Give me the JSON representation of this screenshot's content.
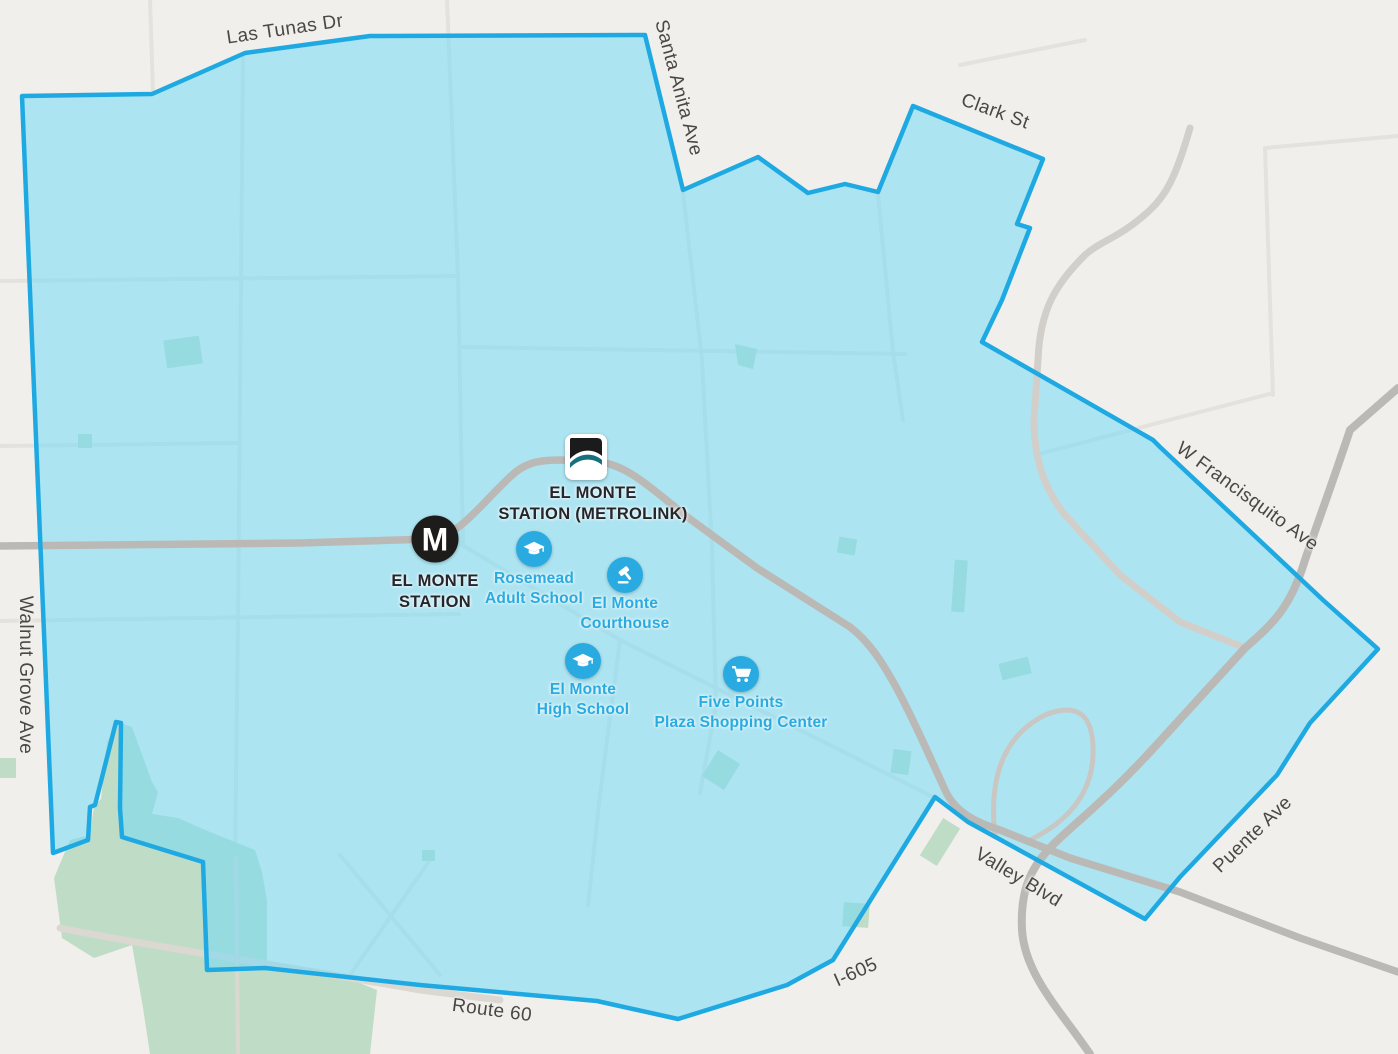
{
  "streets": [
    {
      "label": "Las Tunas Dr"
    },
    {
      "label": "Santa Anita Ave"
    },
    {
      "label": "Clark St"
    },
    {
      "label": "W Francisquito Ave"
    },
    {
      "label": "Walnut Grove Ave"
    },
    {
      "label": "Valley Blvd"
    },
    {
      "label": "Puente Ave"
    },
    {
      "label": "I-605"
    },
    {
      "label": "Route 60"
    }
  ],
  "stations": [
    {
      "line1": "EL MONTE",
      "line2": "STATION (METROLINK)"
    },
    {
      "line1": "EL MONTE",
      "line2": "STATION",
      "logo_letter": "M"
    }
  ],
  "pois": [
    {
      "line1": "Rosemead",
      "line2": "Adult School"
    },
    {
      "line1": "El Monte",
      "line2": "Courthouse"
    },
    {
      "line1": "El Monte",
      "line2": "High School"
    },
    {
      "line1": "Five Points",
      "line2": "Plaza Shopping Center"
    }
  ],
  "colors": {
    "background": "#f1efeb",
    "service_area_fill": "#ace4f2",
    "service_area_border": "#1fa9e2",
    "poi_blue": "#29abe2",
    "park_green": "#bfdcc6",
    "road_gray": "#bbb9b6",
    "street_label_gray": "#4a4745",
    "station_label_dark": "#26252a",
    "metrolink_teal": "#15717d"
  }
}
